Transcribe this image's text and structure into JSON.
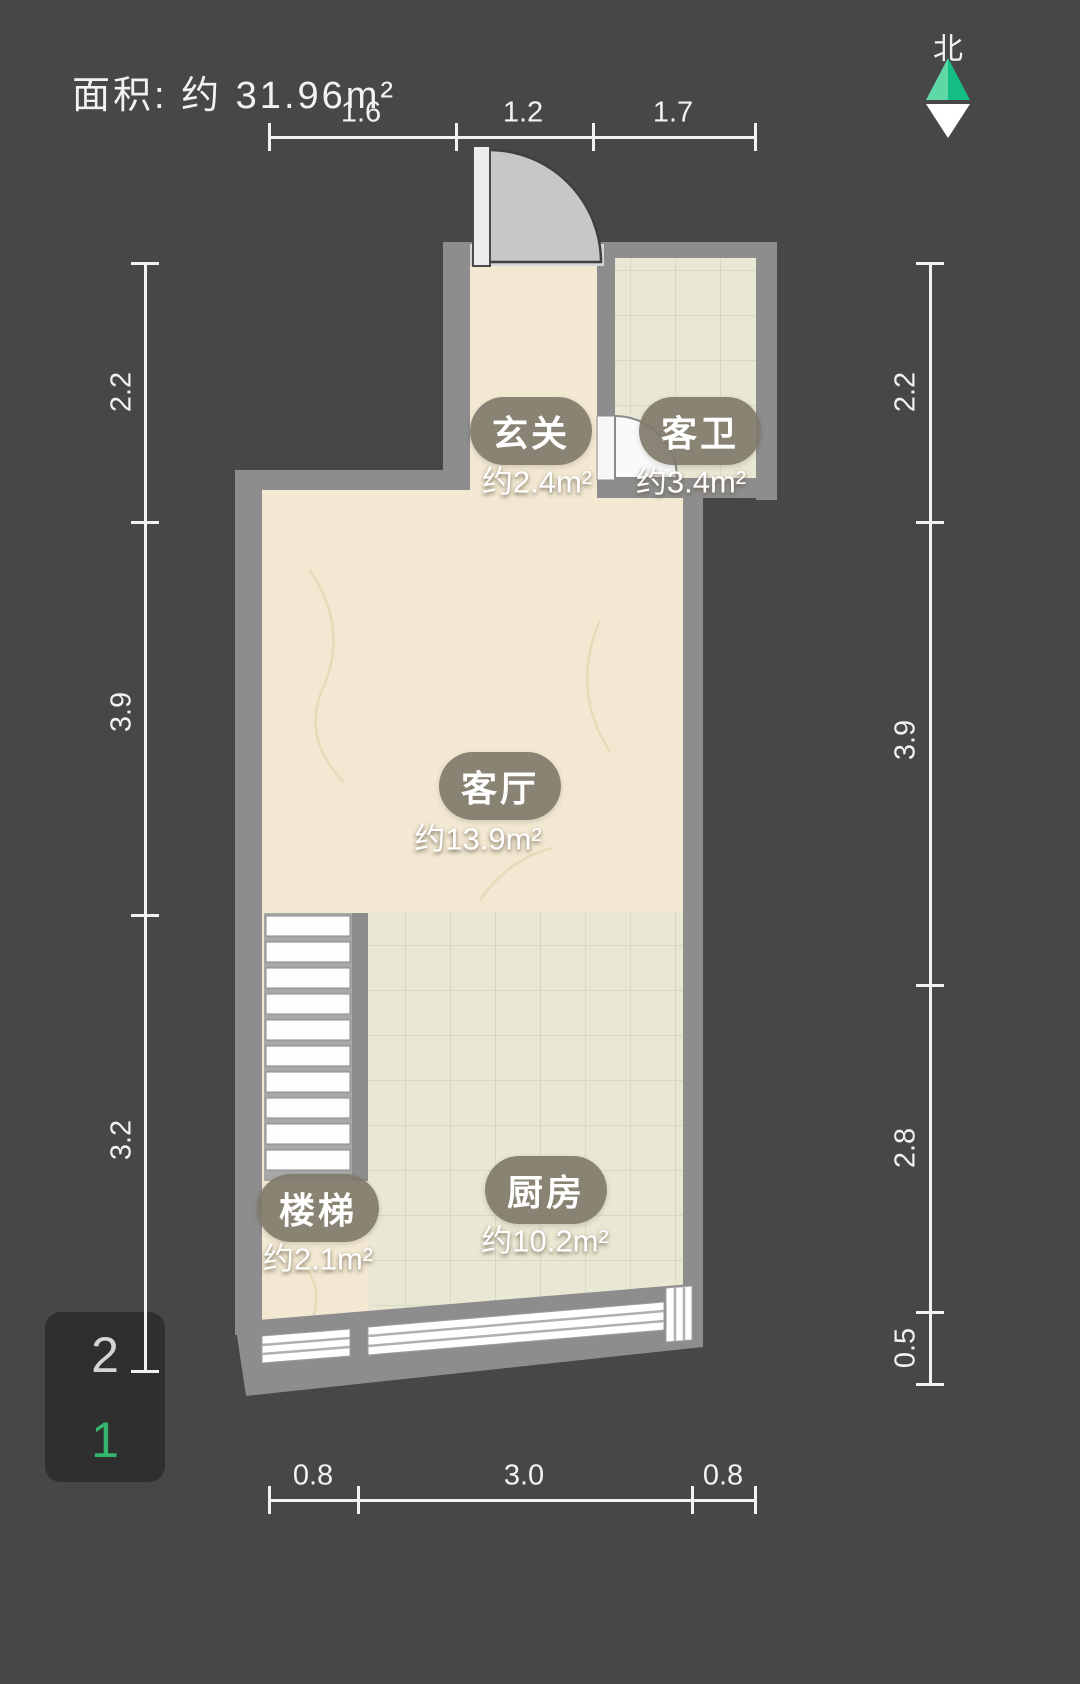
{
  "title": {
    "area_label": "面积: 约 31.96m²"
  },
  "compass": {
    "label": "北"
  },
  "dimensions": {
    "top": [
      "1.6",
      "1.2",
      "1.7"
    ],
    "left": [
      "2.2",
      "3.9",
      "3.2"
    ],
    "right": [
      "2.2",
      "3.9",
      "2.8",
      "0.5"
    ],
    "bottom": [
      "0.8",
      "3.0",
      "0.8"
    ]
  },
  "rooms": [
    {
      "name": "玄关",
      "area": "约2.4m²"
    },
    {
      "name": "客卫",
      "area": "约3.4m²"
    },
    {
      "name": "客厅",
      "area": "约13.9m²"
    },
    {
      "name": "厨房",
      "area": "约10.2m²"
    },
    {
      "name": "楼梯",
      "area": "约2.1m²"
    }
  ],
  "floor_selector": {
    "floors": [
      {
        "label": "2",
        "active": false
      },
      {
        "label": "1",
        "active": true
      }
    ]
  },
  "colors": {
    "bg": "#474747",
    "wall": "#8d8d8d",
    "beige": "#f3e9d3",
    "tile": "#e9e8d4",
    "tile-line": "#d9d8c2",
    "pill": "#87816f",
    "dim": "#f2f2f2",
    "accent": "#34b56e",
    "panel": "#2f2f2f",
    "door": "#c7c7c7",
    "north-green-light": "#5fd8a7",
    "north-green-dark": "#15bd86"
  }
}
